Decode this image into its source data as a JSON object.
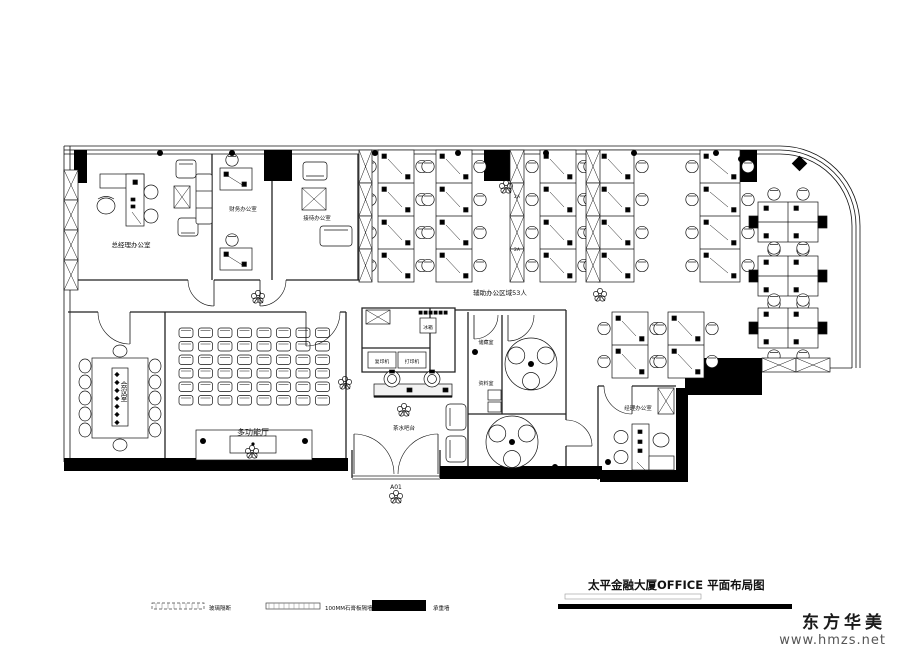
{
  "title_block": {
    "title": "太平金融大厦OFFICE  平面布局图"
  },
  "watermark": {
    "brand": "东方华美",
    "site": "www.hmzs.net"
  },
  "legend": {
    "items": [
      {
        "name": "glass-partition",
        "label": "玻璃隔断"
      },
      {
        "name": "gypsum-wall",
        "label": "100MM石膏板隔墙"
      },
      {
        "name": "load-bearing-wall",
        "label": "承重墙"
      }
    ]
  },
  "rooms": {
    "gm_office": "总经理办公室",
    "finance_office": "财务办公室",
    "reception_office": "接待办公室",
    "meeting_room": "会议室",
    "multi_hall": "多功能厅",
    "copier": "复印机",
    "printer": "打印机",
    "fridge": "冰箱",
    "pantry": "茶水吧台",
    "storage": "储藏室",
    "archive": "资料室",
    "manager_office": "经理办公室",
    "open_area_note": "辅助办公区域53人",
    "entrance_label": "A01",
    "column_marker": "2A"
  },
  "colors": {
    "wall": "#000000",
    "line": "#1a1a1a",
    "watermark_gray": "#555555"
  }
}
